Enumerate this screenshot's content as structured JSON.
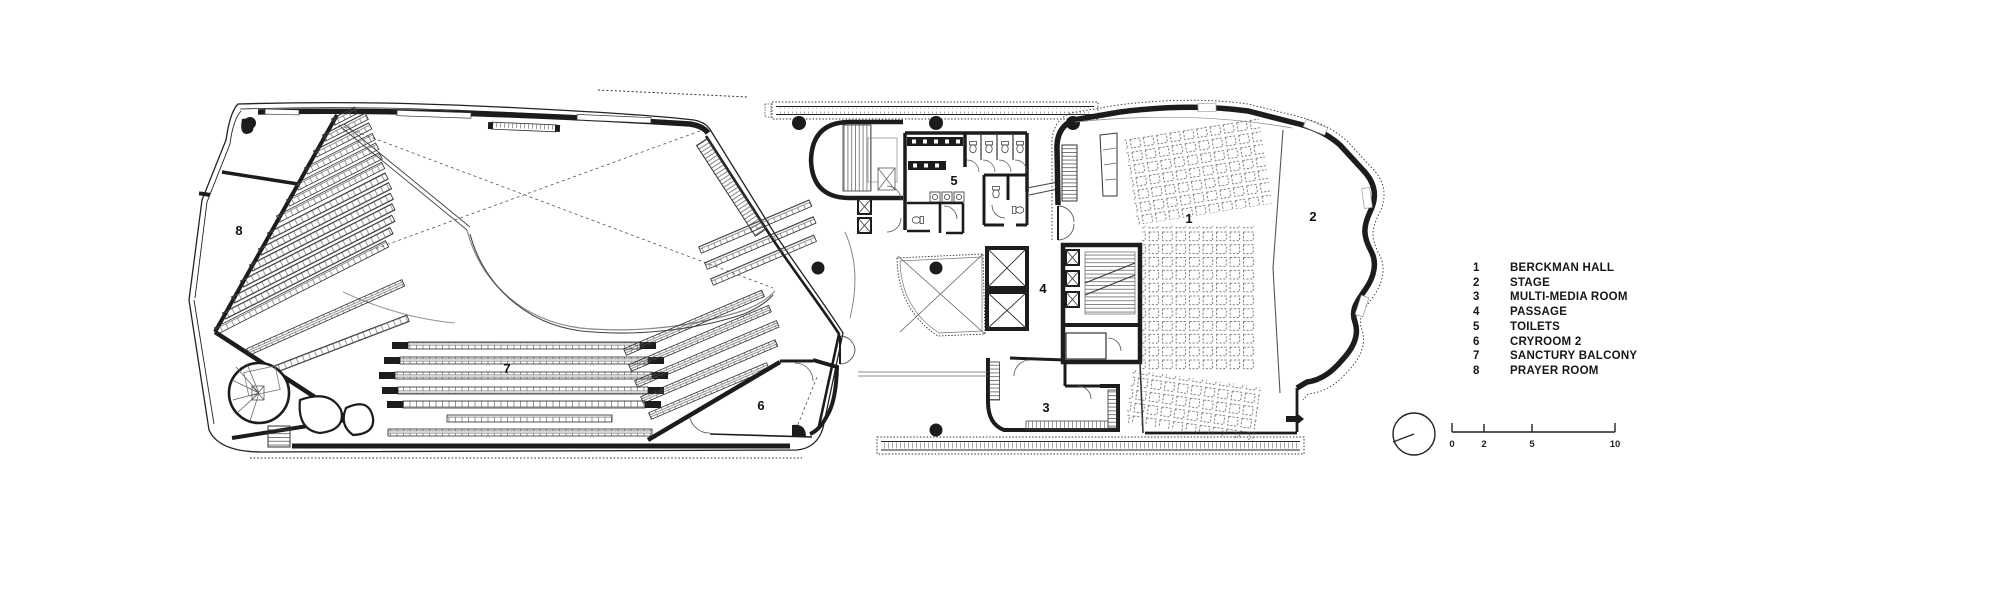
{
  "legend": {
    "items": [
      {
        "number": "1",
        "label": "BERCKMAN HALL"
      },
      {
        "number": "2",
        "label": "STAGE"
      },
      {
        "number": "3",
        "label": "MULTI-MEDIA ROOM"
      },
      {
        "number": "4",
        "label": "PASSAGE"
      },
      {
        "number": "5",
        "label": "TOILETS"
      },
      {
        "number": "6",
        "label": "CRYROOM 2"
      },
      {
        "number": "7",
        "label": "SANCTURY BALCONY"
      },
      {
        "number": "8",
        "label": "PRAYER ROOM"
      }
    ]
  },
  "plan": {
    "room_numbers": [
      "1",
      "2",
      "3",
      "4",
      "5",
      "6",
      "7",
      "8"
    ]
  },
  "scale_bar": {
    "ticks": [
      "0",
      "2",
      "5",
      "10"
    ]
  },
  "colors": {
    "ink": "#1c1c1c",
    "pattern_line": "#555555",
    "light_line": "#808080",
    "background": "#ffffff"
  }
}
